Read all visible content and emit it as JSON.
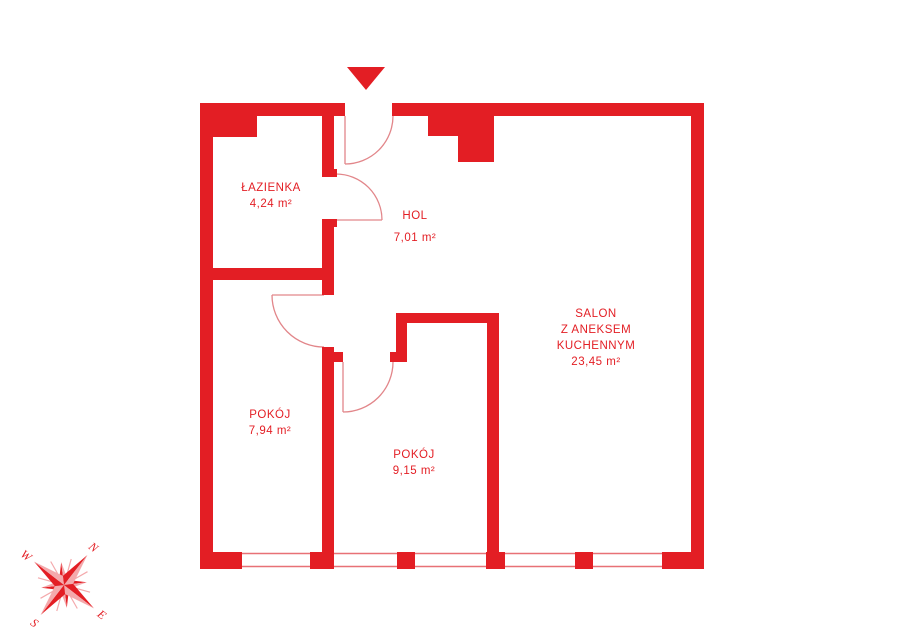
{
  "title": "apartment floor plan",
  "rooms": [
    {
      "id": "lazienka",
      "lines": [
        "ŁAZIENKA",
        "4,24 m²"
      ]
    },
    {
      "id": "hol",
      "lines": [
        "HOL",
        "7,01 m²"
      ]
    },
    {
      "id": "salon",
      "lines": [
        "SALON",
        "Z ANEKSEM",
        "KUCHENNYM",
        "23,45 m²"
      ]
    },
    {
      "id": "pokoj-1",
      "lines": [
        "POKÓJ",
        "7,94 m²"
      ]
    },
    {
      "id": "pokoj-2",
      "lines": [
        "POKÓJ",
        "9,15 m²"
      ]
    }
  ],
  "compass": {
    "north": "N",
    "east": "E",
    "south": "S",
    "west": "W"
  },
  "colors": {
    "wall": "#e31e24",
    "thin_line": "#e2868a",
    "window_line": "#e87176",
    "compass_light": "#f4a9ac"
  }
}
